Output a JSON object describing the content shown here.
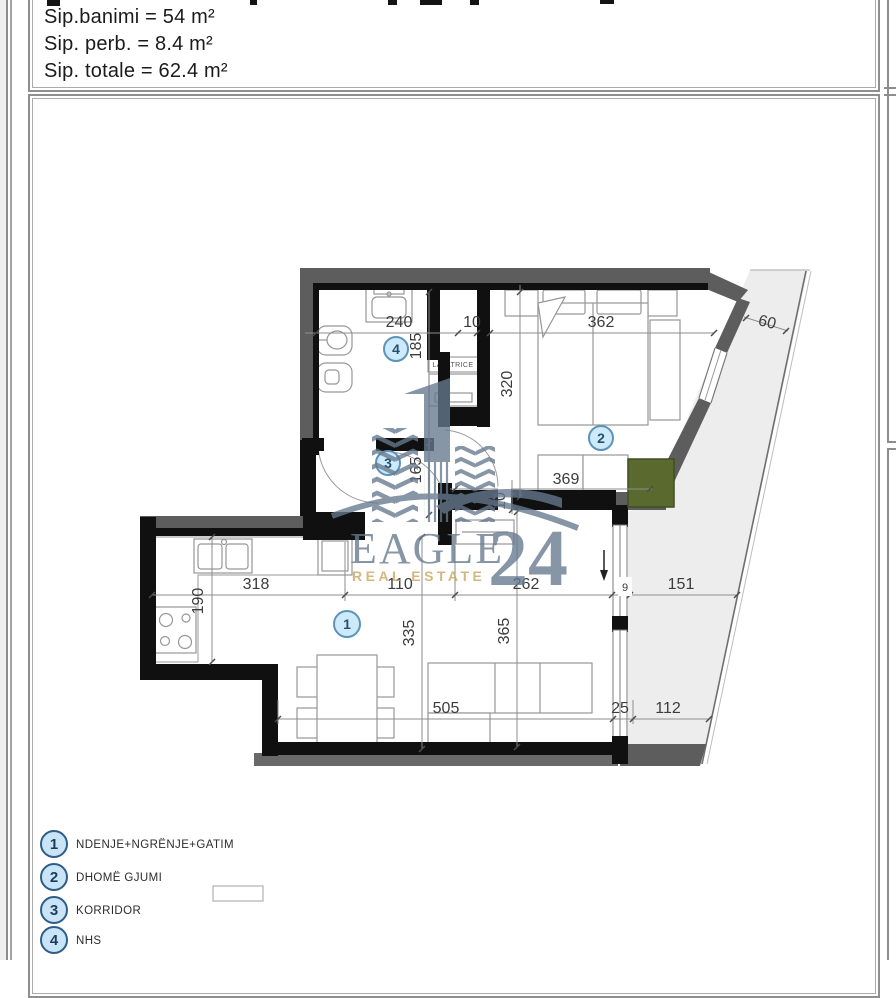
{
  "header": {
    "lines": [
      "Sip.banimi = 54 m²",
      "Sip. perb. = 8.4 m²",
      "Sip. totale = 62.4 m²"
    ]
  },
  "watermark": {
    "brand": "EAGLE",
    "number": "24",
    "tagline": "REAL ESTATE",
    "color": "#66798e",
    "gold": "#c8a45c"
  },
  "plan": {
    "rooms": {
      "r1": "1",
      "r2": "2",
      "r3": "3",
      "r4": "4"
    },
    "labels": {
      "lavatrice": "LAVATRICE"
    },
    "dims": {
      "d240": "240",
      "d10a": "10",
      "d185": "185",
      "d362": "362",
      "d60": "60",
      "d320": "320",
      "d369": "369",
      "d165": "165",
      "d10b": "10",
      "d318": "318",
      "d190": "190",
      "d110": "110",
      "d262": "262",
      "d9": "9",
      "d151": "151",
      "d335": "335",
      "d365": "365",
      "d505": "505",
      "d25": "25",
      "d112": "112"
    },
    "colors": {
      "wall_gray": "#5d5d5d",
      "wall_black": "#101010",
      "balcony_fill": "#ededed",
      "wardrobe_green": "#5a6a2f",
      "marker_fill": "#cdeafa",
      "marker_stroke": "#5d93b8"
    }
  },
  "legend": {
    "items": [
      {
        "num": "1",
        "label": "NDENJE+NGRËNJE+GATIM"
      },
      {
        "num": "2",
        "label": "DHOMË GJUMI"
      },
      {
        "num": "3",
        "label": "KORRIDOR"
      },
      {
        "num": "4",
        "label": "NHS"
      }
    ]
  }
}
